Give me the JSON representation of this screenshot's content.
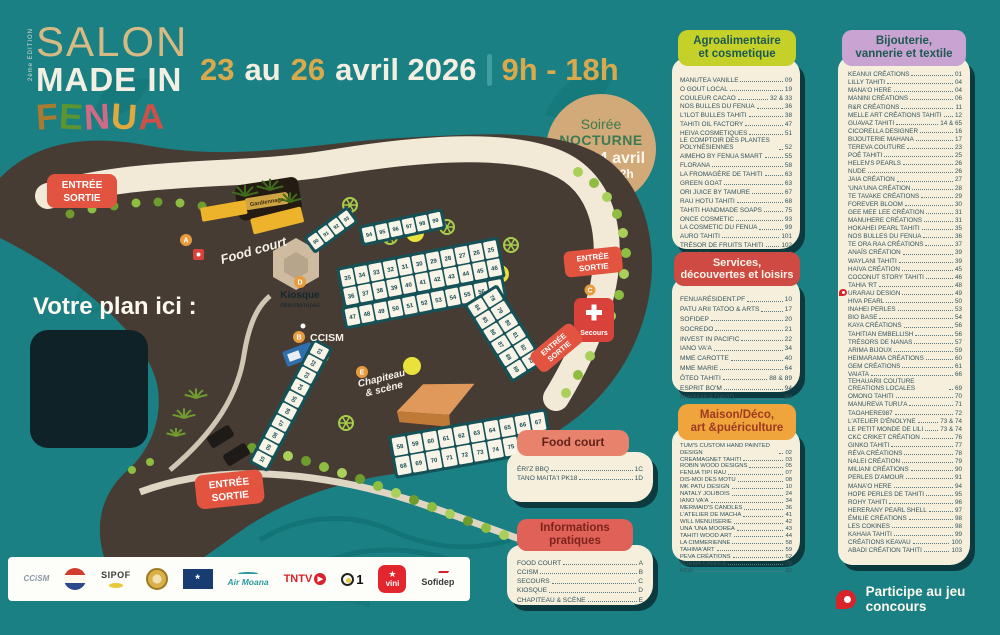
{
  "event": {
    "edition": "2ème ÉDITION",
    "title_top": "SALON",
    "title_mid": "MADE IN",
    "title_fenua": [
      "F",
      "E",
      "N",
      "U",
      "A"
    ],
    "date": {
      "day_from": "23",
      "word_au": "au",
      "day_to": "26",
      "month_year": "avril 2026",
      "hours": "9h - 18h"
    },
    "nocturne": {
      "line1": "Soirée",
      "line2": "NOCTURNE",
      "line3": "Ven 24 avril",
      "line4": "jusqu'à 22h"
    }
  },
  "map": {
    "plan_here": "Votre plan ici :",
    "entrance_line1": "ENTRÉE",
    "entrance_line2": "SORTIE",
    "labels": {
      "food_court": "Food court",
      "kiosque": "Kiosque",
      "kiosque_sub": "détente/repas",
      "ccism": "CCISM",
      "chapiteau_l1": "Chapiteau",
      "chapiteau_l2": "& scène",
      "secours": "Secours",
      "guard": "Gardiennage"
    },
    "markers": {
      "a": "A",
      "b": "B",
      "c": "C",
      "d": "D",
      "e": "E"
    },
    "booths": {
      "row_small": [
        "90",
        "91",
        "92",
        "93"
      ],
      "row_top": [
        "94",
        "95",
        "96",
        "97",
        "98",
        "99"
      ],
      "block1_r1": [
        "35",
        "34",
        "33",
        "32",
        "31",
        "30",
        "29",
        "28",
        "27",
        "26",
        "25"
      ],
      "block1_r2": [
        "36",
        "37",
        "38",
        "39",
        "40",
        "41",
        "42",
        "43",
        "44",
        "45",
        "46"
      ],
      "block1_r3": [
        "47",
        "48",
        "49",
        "50",
        "51",
        "52",
        "53",
        "54",
        "55",
        "56",
        "57"
      ],
      "block2_r1": [
        "58",
        "59",
        "60",
        "61",
        "62",
        "63",
        "64",
        "65",
        "66",
        "67"
      ],
      "block2_r2": [
        "68",
        "69",
        "70",
        "71",
        "72",
        "73",
        "74",
        "75",
        "76",
        "77"
      ],
      "side_col1": [
        "78",
        "79",
        "80",
        "81",
        "82",
        "83"
      ],
      "side_col2": [
        "84",
        "85",
        "86",
        "87",
        "88",
        "89"
      ],
      "left_strip": [
        "10",
        "09",
        "08",
        "07",
        "06",
        "05",
        "04",
        "03",
        "02",
        "01"
      ]
    }
  },
  "sections": {
    "agro": {
      "title_l1": "Agroalimentaire",
      "title_l2": "et cosmetique",
      "items": [
        {
          "n": "MANUTEA VANILLE",
          "p": "09"
        },
        {
          "n": "O GOUT LOCAL",
          "p": "19"
        },
        {
          "n": "COULEUR CACAO",
          "p": "32 & 33"
        },
        {
          "n": "NOS BULLES DU FENUA",
          "p": "36"
        },
        {
          "n": "L'ILOT BULLES TAHITI",
          "p": "38"
        },
        {
          "n": "TAHITI OIL FACTORY",
          "p": "47"
        },
        {
          "n": "HEIVA COSMETIQUES",
          "p": "51"
        },
        {
          "n": "LE COMPTOIR DES PLANTES POLYNÉSIENNES",
          "p": "52"
        },
        {
          "n": "AIMEHO BY FENUA SMART",
          "p": "55"
        },
        {
          "n": "FLORANA",
          "p": "58"
        },
        {
          "n": "LA FROMAGÈRE DE TAHITI",
          "p": "63"
        },
        {
          "n": "GREEN GOAT",
          "p": "63"
        },
        {
          "n": "ORI JUICE BY TAMURE",
          "p": "67"
        },
        {
          "n": "RAU HOTU TAHITI",
          "p": "68"
        },
        {
          "n": "TAHITI HANDMADE SOAPS",
          "p": "75"
        },
        {
          "n": "ONCE COSMETIC",
          "p": "93"
        },
        {
          "n": "LA COSMETIC DU FENUA",
          "p": "99"
        },
        {
          "n": "AURO TAHITI",
          "p": "101"
        },
        {
          "n": "TRÉSOR DE FRUITS TAHITI",
          "p": "102"
        },
        {
          "n": "BOUNT'ITI",
          "p": "115"
        }
      ]
    },
    "services": {
      "title_l1": "Services,",
      "title_l2": "découvertes et loisirs",
      "items": [
        {
          "n": "FENUARÉSIDENT.PF",
          "p": "10"
        },
        {
          "n": "PATU ARII TATOO & ARTS",
          "p": "17"
        },
        {
          "n": "SOFIDEP",
          "p": "20"
        },
        {
          "n": "SOCREDO",
          "p": "21"
        },
        {
          "n": "INVEST IN PACIFIC",
          "p": "22"
        },
        {
          "n": "IANO VA'A",
          "p": "34"
        },
        {
          "n": "MME CAROTTE",
          "p": "40"
        },
        {
          "n": "MME MARIE",
          "p": "64"
        },
        {
          "n": "ŌTEO TAHITI",
          "p": "88 & 89"
        },
        {
          "n": "ESPRIT BO'M",
          "p": "94"
        },
        {
          "n": "MIHIMANA DAVID",
          "p": "94"
        }
      ]
    },
    "maison": {
      "title_l1": "Maison/Déco,",
      "title_l2": "art &puériculture",
      "items": [
        {
          "n": "TUM'S CUSTOM HAND PAINTED DESIGN",
          "p": "02"
        },
        {
          "n": "CREAMAGNET TAHITI",
          "p": "03"
        },
        {
          "n": "ROBIN WOOD DESIGNS",
          "p": "05"
        },
        {
          "n": "FENUA TIPI RAU",
          "p": "07"
        },
        {
          "n": "DIS-MOI DES MOTU",
          "p": "08"
        },
        {
          "n": "MK PATU DESIGN",
          "p": "10"
        },
        {
          "n": "NATALY JOLIBOIS",
          "p": "24"
        },
        {
          "n": "IANO VA'A",
          "p": "34"
        },
        {
          "n": "MERMAID'S CANDLES",
          "p": "36"
        },
        {
          "n": "L'ATELIER DE MACHA",
          "p": "41"
        },
        {
          "n": "WILL MENUISERIE",
          "p": "42"
        },
        {
          "n": "UNA 'UNA MOOREA",
          "p": "43"
        },
        {
          "n": "TAHITI WOOD ART",
          "p": "44"
        },
        {
          "n": "LA CIMMERIENNE",
          "p": "58"
        },
        {
          "n": "TAHIMA'ART",
          "p": "59"
        },
        {
          "n": "PEVA CRÉATIONS",
          "p": "62"
        },
        {
          "n": "POEMA CANDLE",
          "p": "76"
        },
        {
          "n": "MOII",
          "p": "92"
        }
      ]
    },
    "bijou": {
      "title_l1": "Bijouterie,",
      "title_l2": "vannerie et textile",
      "items": [
        {
          "n": "KEANUI CRÉATIONS",
          "p": "01"
        },
        {
          "n": "LILLY TAHITI",
          "p": "04"
        },
        {
          "n": "MANA'O HERE",
          "p": "04"
        },
        {
          "n": "MANINI CRÉATIONS",
          "p": "06"
        },
        {
          "n": "R&R CRÉATIONS",
          "p": "11"
        },
        {
          "n": "MELLE ART CRÉATIONS TAHITI",
          "p": "12"
        },
        {
          "n": "GUAVAZ TAHITI",
          "p": "14 & 65"
        },
        {
          "n": "CICORELLA DESIGNER",
          "p": "16"
        },
        {
          "n": "BIJOUTERIE MAHANA",
          "p": "17"
        },
        {
          "n": "TEREVA COUTURE",
          "p": "23"
        },
        {
          "n": "POÉ TAHITI",
          "p": "25"
        },
        {
          "n": "HELEN'S PEARLS",
          "p": "26"
        },
        {
          "n": "NUDE",
          "p": "26"
        },
        {
          "n": "JAIA CRÉATION",
          "p": "27"
        },
        {
          "n": "'UNA'UNA CRÉATION",
          "p": "28"
        },
        {
          "n": "TE TAVAKE CRÉATIONS",
          "p": "29"
        },
        {
          "n": "FOREVER BLOOM",
          "p": "30"
        },
        {
          "n": "GEE MEE LEE CRÉATION",
          "p": "31"
        },
        {
          "n": "MANUHERE CRÉATIONS",
          "p": "31"
        },
        {
          "n": "HOKAHEI PEARL TAHITI",
          "p": "35"
        },
        {
          "n": "NOS BULLES DU FENUA",
          "p": "36"
        },
        {
          "n": "TE ORA RAA CRÉATIONS",
          "p": "37"
        },
        {
          "n": "ANAÏS CRÉATION",
          "p": "39"
        },
        {
          "n": "WAYLANI TAHITI",
          "p": "39"
        },
        {
          "n": "HAIVA CRÉATION",
          "p": "45"
        },
        {
          "n": "COCONUT STORY TAHITI",
          "p": "46"
        },
        {
          "n": "TAHIA 'RT",
          "p": "48"
        },
        {
          "n": "URARAU DESIGN",
          "p": "49",
          "pin": true
        },
        {
          "n": "HIVA PEARL",
          "p": "50"
        },
        {
          "n": "INAHEI PERLES",
          "p": "53"
        },
        {
          "n": "BIO BASE",
          "p": "54"
        },
        {
          "n": "KAYA CRÉATIONS",
          "p": "56"
        },
        {
          "n": "TAHITIAN EMBELLISH",
          "p": "56"
        },
        {
          "n": "TRÉSORS DE NANAS",
          "p": "57"
        },
        {
          "n": "ARIMA BIJOUX",
          "p": "59"
        },
        {
          "n": "HEIMARAMA CRÉATIONS",
          "p": "60"
        },
        {
          "n": "GEM CRÉATIONS",
          "p": "61"
        },
        {
          "n": "VAIATA",
          "p": "66"
        },
        {
          "n": "TEHAUARII COUTURE CREATIONS LOCALES",
          "p": "69"
        },
        {
          "n": "OMONO TAHITI",
          "p": "70"
        },
        {
          "n": "MANUREVA TURU'A",
          "p": "71"
        },
        {
          "n": "TAOAHERE987",
          "p": "72"
        },
        {
          "n": "L'ATELIER D'ÉNOLYNE",
          "p": "73 & 74"
        },
        {
          "n": "LE PETIT MONDE DE LILI",
          "p": "73 & 74"
        },
        {
          "n": "CKC CRIKET CRÉATION",
          "p": "76"
        },
        {
          "n": "GINKO TAHITI",
          "p": "77"
        },
        {
          "n": "RÉVA CRÉATIONS",
          "p": "78"
        },
        {
          "n": "NALEI CRÉATION",
          "p": "79"
        },
        {
          "n": "MILIANI CRÉATIONS",
          "p": "90"
        },
        {
          "n": "PERLES D'AMOUR",
          "p": "91"
        },
        {
          "n": "MANA'O HERE",
          "p": "94"
        },
        {
          "n": "HOPE PERLES DE TAHITI",
          "p": "95"
        },
        {
          "n": "ROHY TAHITI",
          "p": "96"
        },
        {
          "n": "HERERANY PEARL SHELL",
          "p": "97"
        },
        {
          "n": "ÉMILIE CRÉATIONS",
          "p": "98"
        },
        {
          "n": "LES COKINES",
          "p": "98"
        },
        {
          "n": "KAHAIA TAHITI",
          "p": "99"
        },
        {
          "n": "CRÉATIONS KEAVAU",
          "p": "100"
        },
        {
          "n": "ABADI CRÉATION TAHITI",
          "p": "103"
        }
      ]
    }
  },
  "food_court": {
    "title": "Food court",
    "items": [
      {
        "n": "ÉRI'Z BBQ",
        "p": "1C"
      },
      {
        "n": "TANO MAITA'I PK18",
        "p": "1D"
      }
    ]
  },
  "infos": {
    "title_l1": "Informations",
    "title_l2": "pratiques",
    "items": [
      {
        "n": "FOOD COURT",
        "p": "A"
      },
      {
        "n": "CCISM",
        "p": "B"
      },
      {
        "n": "SECOURS",
        "p": "C"
      },
      {
        "n": "KIOSQUE",
        "p": "D"
      },
      {
        "n": "CHAPITEAU & SCÈNE",
        "p": "E"
      }
    ]
  },
  "sponsors": {
    "ccism": "CCiSM",
    "sipof": "SIPOF",
    "air_moana": "Air Moana",
    "tntv": "TNTV",
    "one": "1",
    "vini": "vini",
    "sofidep": "Sofidep"
  },
  "contest": "Participe au jeu concours",
  "colors": {
    "background": "#1A8083",
    "cream": "#F5EFDC",
    "red": "#D8423B",
    "gold": "#D9A94E"
  }
}
